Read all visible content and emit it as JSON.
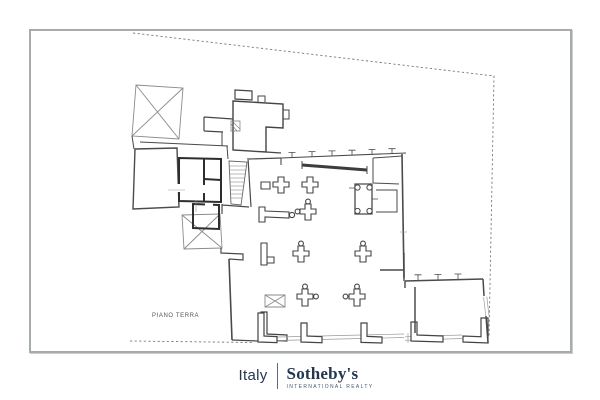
{
  "frame": {
    "border_color": "#a6abae"
  },
  "plan": {
    "label": "PIANO TERRA",
    "ink_color": "#4a4a4a",
    "boundary_color": "#787878",
    "boundary_style": "dashed"
  },
  "footer": {
    "country": "Italy",
    "brand": "Sotheby's",
    "tagline": "INTERNATIONAL REALTY",
    "color": "#22384e"
  }
}
